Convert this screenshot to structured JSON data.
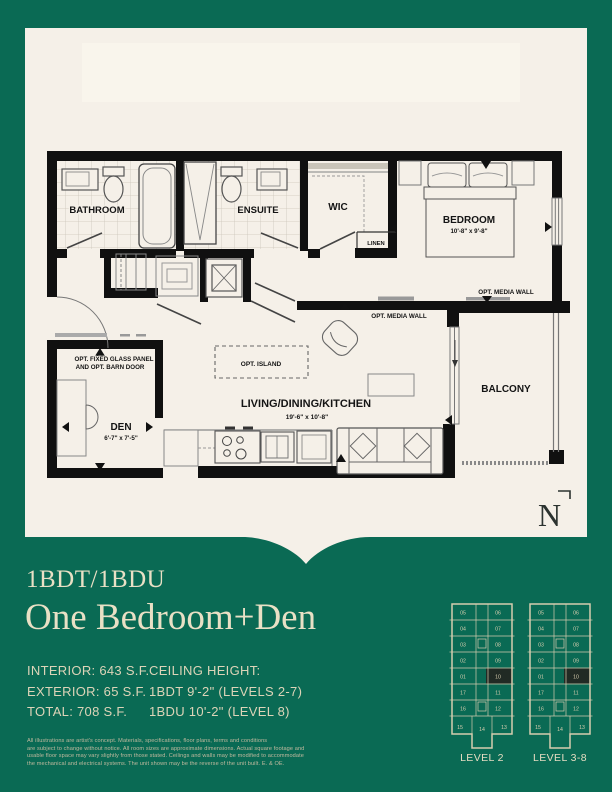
{
  "header": {
    "unit_code": "1BDT/1BDU",
    "unit_name": "One Bedroom+Den"
  },
  "stats": {
    "interior": "INTERIOR: 643 S.F.",
    "exterior": "EXTERIOR: 65 S.F.",
    "total": "TOTAL: 708 S.F.",
    "ceiling_heading": "CEILING HEIGHT:",
    "ceiling_line1": "1BDT 9'-2\" (LEVELS 2-7)",
    "ceiling_line2": "1BDU 10'-2\" (LEVEL 8)"
  },
  "disclaimer": {
    "lines": [
      "All illustrations are artist's concept. Materials, specifications, floor plans, terms and conditions",
      "are subject to change without notice. All room sizes are approximate dimensions. Actual square footage and",
      "usable floor space may vary slightly from those stated. Ceilings and walls may be modified to accommodate",
      "the mechanical and electrical systems.  The unit shown may be the reverse of the unit built. E. & OE."
    ]
  },
  "floorplan": {
    "bathroom": "BATHROOM",
    "ensuite": "ENSUITE",
    "wic": "WIC",
    "linen": "LINEN",
    "bedroom": "BEDROOM",
    "bedroom_dims": "10'-8\" x 9'-8\"",
    "living": "LIVING/DINING/KITCHEN",
    "living_dims": "19'-6\" x 10'-8\"",
    "den": "DEN",
    "den_dims": "6'-7\" x 7'-5\"",
    "balcony": "BALCONY",
    "opt_island": "OPT. ISLAND",
    "opt_media_wall_center": "OPT. MEDIA WALL",
    "opt_media_wall_right": "OPT. MEDIA WALL",
    "opt_glass_line1": "OPT. FIXED GLASS PANEL",
    "opt_glass_line2": "AND OPT. BARN DOOR",
    "north_letter": "N"
  },
  "keyplans": [
    {
      "label": "LEVEL 2",
      "rows": [
        [
          "05",
          "06"
        ],
        [
          "04",
          "07"
        ],
        [
          "03",
          "08"
        ],
        [
          "02",
          "09"
        ],
        [
          "01",
          "10"
        ],
        [
          "17",
          "11"
        ],
        [
          "16",
          "12"
        ]
      ],
      "bottom_row": [
        "15",
        "14",
        "13"
      ],
      "highlighted_unit": "10"
    },
    {
      "label": "LEVEL 3-8",
      "rows": [
        [
          "05",
          "06"
        ],
        [
          "04",
          "07"
        ],
        [
          "03",
          "08"
        ],
        [
          "02",
          "09"
        ],
        [
          "01",
          "10"
        ],
        [
          "17",
          "11"
        ],
        [
          "16",
          "12"
        ]
      ],
      "bottom_row": [
        "15",
        "14",
        "13"
      ],
      "highlighted_unit": "10"
    }
  ],
  "colors": {
    "background_green": "#0a6a54",
    "page_cream": "#f5f0e8",
    "watermark_cream": "#f9f5ec",
    "text_cream": "#e9e0c5",
    "keyplan_line": "#d6cdae",
    "highlight_unit": "#212a24",
    "plan_ink": "#101010"
  }
}
